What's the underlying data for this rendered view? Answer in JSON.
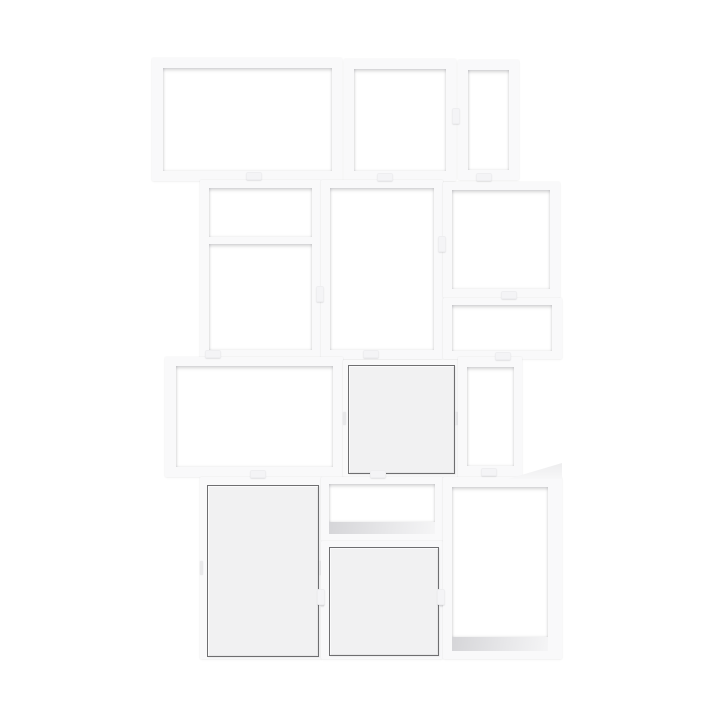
{
  "product": {
    "description": "White modular stacked cube shelving unit: three open boxes on top row; a divided double cube, tall open cube and two open cubes on second row; wide open box, square door cabinet and narrow open box on third row; tall door cabinet, shallow open box over a door cabinet, and tall open box on bottom row; joined with small connector clips."
  },
  "colors": {
    "background": "#ffffff",
    "frame": "#f9f9fa",
    "opening": "#ffffff",
    "door_fill": "#f1f1f2",
    "door_border": "#6e6e70",
    "floor_shadow": "#d5d5d8",
    "clip": "#f4f4f6"
  },
  "modules": [
    {
      "id": "top-wide-open-box",
      "x": 152,
      "y": 58,
      "w": 190,
      "h": 123,
      "children": [
        {
          "kind": "opening",
          "r": [
            11,
            10,
            169,
            103
          ]
        }
      ]
    },
    {
      "id": "top-middle-open-box",
      "x": 344,
      "y": 59,
      "w": 112,
      "h": 122,
      "children": [
        {
          "kind": "opening",
          "r": [
            10,
            10,
            92,
            102
          ]
        }
      ]
    },
    {
      "id": "top-narrow-open-box",
      "x": 458,
      "y": 60,
      "w": 61,
      "h": 120,
      "children": [
        {
          "kind": "opening",
          "r": [
            10,
            10,
            41,
            100
          ]
        }
      ]
    },
    {
      "id": "second-left-divided-box",
      "x": 200,
      "y": 180,
      "w": 121,
      "h": 179,
      "children": [
        {
          "kind": "opening",
          "r": [
            9,
            8,
            103,
            49
          ]
        },
        {
          "kind": "opening",
          "r": [
            9,
            64,
            103,
            106
          ]
        }
      ]
    },
    {
      "id": "second-middle-tall-open-box",
      "x": 321,
      "y": 180,
      "w": 122,
      "h": 179,
      "children": [
        {
          "kind": "opening",
          "r": [
            9,
            8,
            104,
            162
          ]
        }
      ]
    },
    {
      "id": "second-right-open-box",
      "x": 443,
      "y": 182,
      "w": 117,
      "h": 116,
      "children": [
        {
          "kind": "opening",
          "r": [
            9,
            8,
            98,
            99
          ]
        }
      ]
    },
    {
      "id": "second-right-low-open-box",
      "x": 443,
      "y": 298,
      "w": 119,
      "h": 61,
      "children": [
        {
          "kind": "opening",
          "r": [
            9,
            7,
            100,
            46
          ]
        }
      ]
    },
    {
      "id": "third-left-wide-open-box",
      "x": 165,
      "y": 357,
      "w": 178,
      "h": 120,
      "children": [
        {
          "kind": "opening",
          "r": [
            11,
            9,
            157,
            101
          ]
        }
      ]
    },
    {
      "id": "third-middle-door-cabinet",
      "x": 343,
      "y": 360,
      "w": 115,
      "h": 117,
      "children": [
        {
          "kind": "door",
          "r": [
            5,
            5,
            105,
            107
          ]
        },
        {
          "kind": "hinge",
          "r": [
            0,
            52,
            3,
            13
          ]
        },
        {
          "kind": "hinge",
          "r": [
            112,
            52,
            3,
            13
          ]
        }
      ]
    },
    {
      "id": "third-right-narrow-open-box",
      "x": 458,
      "y": 357,
      "w": 64,
      "h": 121,
      "children": [
        {
          "kind": "opening",
          "r": [
            9,
            10,
            47,
            99
          ]
        }
      ]
    },
    {
      "id": "bottom-left-door-cabinet",
      "x": 200,
      "y": 477,
      "w": 122,
      "h": 182,
      "children": [
        {
          "kind": "door",
          "r": [
            7,
            8,
            110,
            170
          ]
        },
        {
          "kind": "hinge",
          "r": [
            0,
            84,
            3,
            14
          ]
        },
        {
          "kind": "hinge",
          "r": [
            119,
            84,
            3,
            14
          ]
        }
      ]
    },
    {
      "id": "bottom-middle-shallow-open-box",
      "x": 321,
      "y": 477,
      "w": 122,
      "h": 64,
      "children": [
        {
          "kind": "opening",
          "r": [
            8,
            7,
            106,
            38
          ]
        },
        {
          "kind": "floor",
          "r": [
            8,
            45,
            106,
            12
          ]
        }
      ]
    },
    {
      "id": "bottom-middle-door-cabinet",
      "x": 321,
      "y": 541,
      "w": 122,
      "h": 118,
      "children": [
        {
          "kind": "door",
          "r": [
            8,
            6,
            108,
            107
          ]
        },
        {
          "kind": "hinge",
          "r": [
            0,
            53,
            3,
            13
          ]
        },
        {
          "kind": "hinge",
          "r": [
            119,
            53,
            3,
            13
          ]
        }
      ]
    },
    {
      "id": "bottom-right-tall-open-box",
      "x": 443,
      "y": 477,
      "w": 119,
      "h": 182,
      "children": [
        {
          "kind": "topface",
          "r": [
            65,
            -14,
            54,
            16
          ]
        },
        {
          "kind": "opening",
          "r": [
            9,
            10,
            96,
            150
          ]
        },
        {
          "kind": "floor",
          "r": [
            9,
            160,
            96,
            14
          ]
        }
      ]
    }
  ],
  "clips": [
    {
      "x": 246,
      "y": 172,
      "o": "h"
    },
    {
      "x": 377,
      "y": 173,
      "o": "h"
    },
    {
      "x": 476,
      "y": 173,
      "o": "h"
    },
    {
      "x": 452,
      "y": 108,
      "o": "v"
    },
    {
      "x": 316,
      "y": 286,
      "o": "v"
    },
    {
      "x": 438,
      "y": 236,
      "o": "v"
    },
    {
      "x": 501,
      "y": 291,
      "o": "h"
    },
    {
      "x": 205,
      "y": 350,
      "o": "h"
    },
    {
      "x": 363,
      "y": 350,
      "o": "h"
    },
    {
      "x": 495,
      "y": 352,
      "o": "h"
    },
    {
      "x": 250,
      "y": 470,
      "o": "h"
    },
    {
      "x": 370,
      "y": 470,
      "o": "h"
    },
    {
      "x": 481,
      "y": 468,
      "o": "h"
    },
    {
      "x": 317,
      "y": 589,
      "o": "v"
    },
    {
      "x": 437,
      "y": 589,
      "o": "v"
    }
  ]
}
